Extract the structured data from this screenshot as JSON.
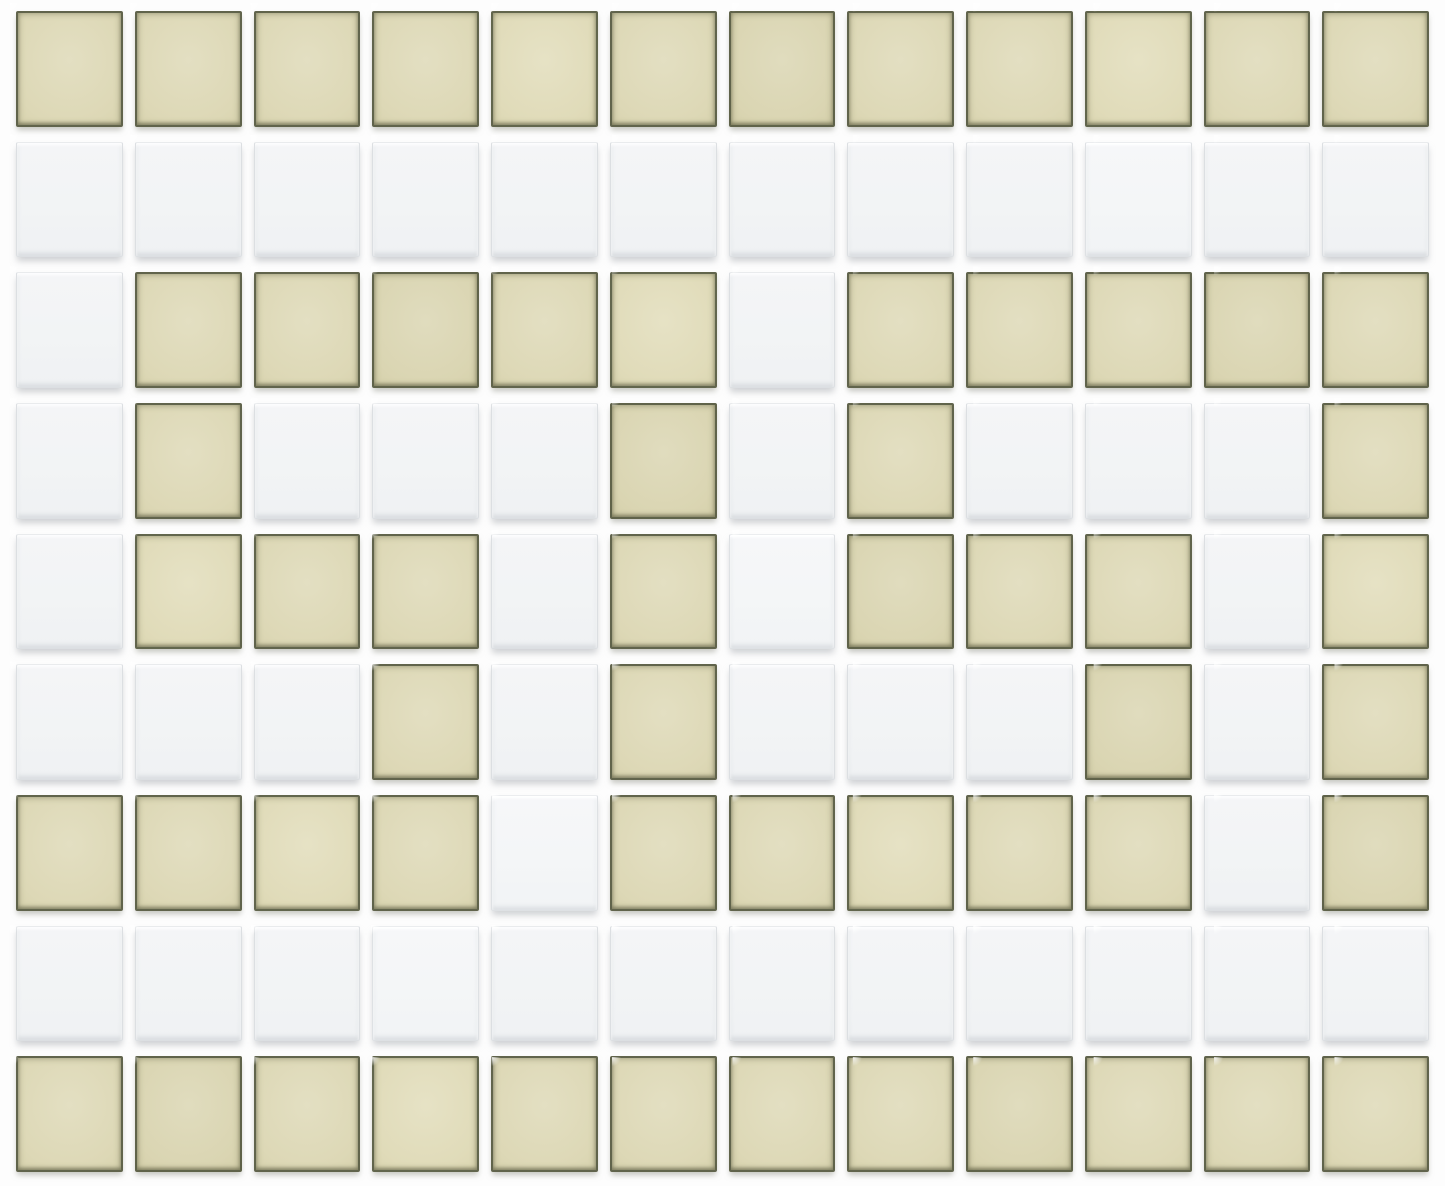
{
  "mosaic": {
    "description": "checker-style ceramic mosaic tile sheet forming a Greek key border pattern",
    "columns": 12,
    "rows": 9,
    "pattern": [
      "BBBBBBBBBBBB",
      "WWWWWWWWWWWW",
      "WBBBBBWBBBBB",
      "WBWWWBWBWWWB",
      "WBBBWBWBBBWB",
      "WWWBWBWWWBWB",
      "BBBBWBBBBBWB",
      "WWWWWWWWWWWW",
      "BBBBBBBBBBBB"
    ],
    "legend": {
      "B": "beige",
      "W": "white"
    },
    "colors": {
      "beige_tile_center": "#ddd8b6",
      "beige_tile_edge": "#908d6d",
      "beige_tile_border": "#474b34",
      "white_tile_center": "#f2f4f5",
      "white_tile_border": "#dcdfe2",
      "grout": "#fdfdfd",
      "tile_shadow": "#a8acb0"
    },
    "tile_counts": {
      "beige": 58,
      "white": 50
    }
  }
}
